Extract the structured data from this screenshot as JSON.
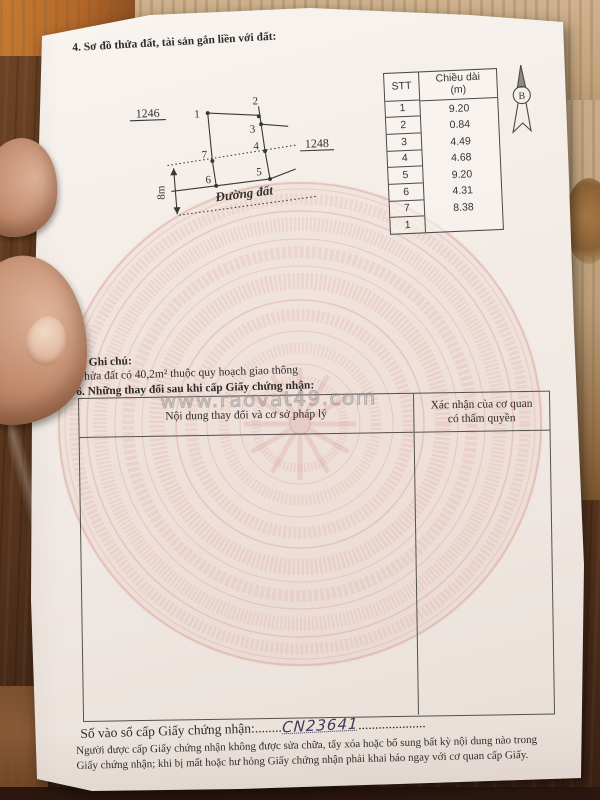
{
  "page": {
    "section4_title": "4. Sơ đồ thửa đất, tài sản gắn liền với đất:",
    "section5_title": "5. Ghi chú:",
    "section5_note": "Thửa đất có 40,2m² thuộc quy hoạch giao thông",
    "section6_title": "6. Những thay đổi sau khi cấp Giấy chứng nhận:"
  },
  "diagram": {
    "parcel_left": "1246",
    "parcel_right": "1248",
    "road_label": "Đường đất",
    "width_label": "8m",
    "points": [
      "1",
      "2",
      "3",
      "4",
      "5",
      "6",
      "7"
    ],
    "compass_letter": "B"
  },
  "dim_table": {
    "col1_header": "STT",
    "col2_header_line1": "Chiều dài",
    "col2_header_line2": "(m)",
    "stt": [
      "1",
      "2",
      "3",
      "4",
      "5",
      "6",
      "7",
      "1"
    ],
    "lengths": [
      "9.20",
      "0.84",
      "4.49",
      "4.68",
      "9.20",
      "4.31",
      "8.38"
    ]
  },
  "change_table": {
    "col1_header": "Nội dung thay đổi và cơ sở pháp lý",
    "col2_header_line1": "Xác nhận của cơ quan",
    "col2_header_line2": "có thẩm quyền"
  },
  "watermark": "www.raovat49.com",
  "registry": {
    "label": "Số vào sổ cấp Giấy chứng nhận:",
    "dots_before": "........",
    "number": "CN23641",
    "dots_after": "...................."
  },
  "footer": {
    "line1": "Người được cấp Giấy chứng nhận không được sửa chữa, tẩy xóa hoặc bổ sung bất kỳ nội dung nào trong",
    "line2": "Giấy chứng nhận; khi bị mất hoặc hư hỏng Giấy chứng nhận phải khai báo ngay với cơ quan cấp Giấy."
  },
  "colors": {
    "drum_pink": "#cd7d73",
    "paper": "#f4ede8",
    "wood_dark": "#53321c",
    "wood_light": "#c9ad89",
    "ink": "#2e2c2a"
  }
}
